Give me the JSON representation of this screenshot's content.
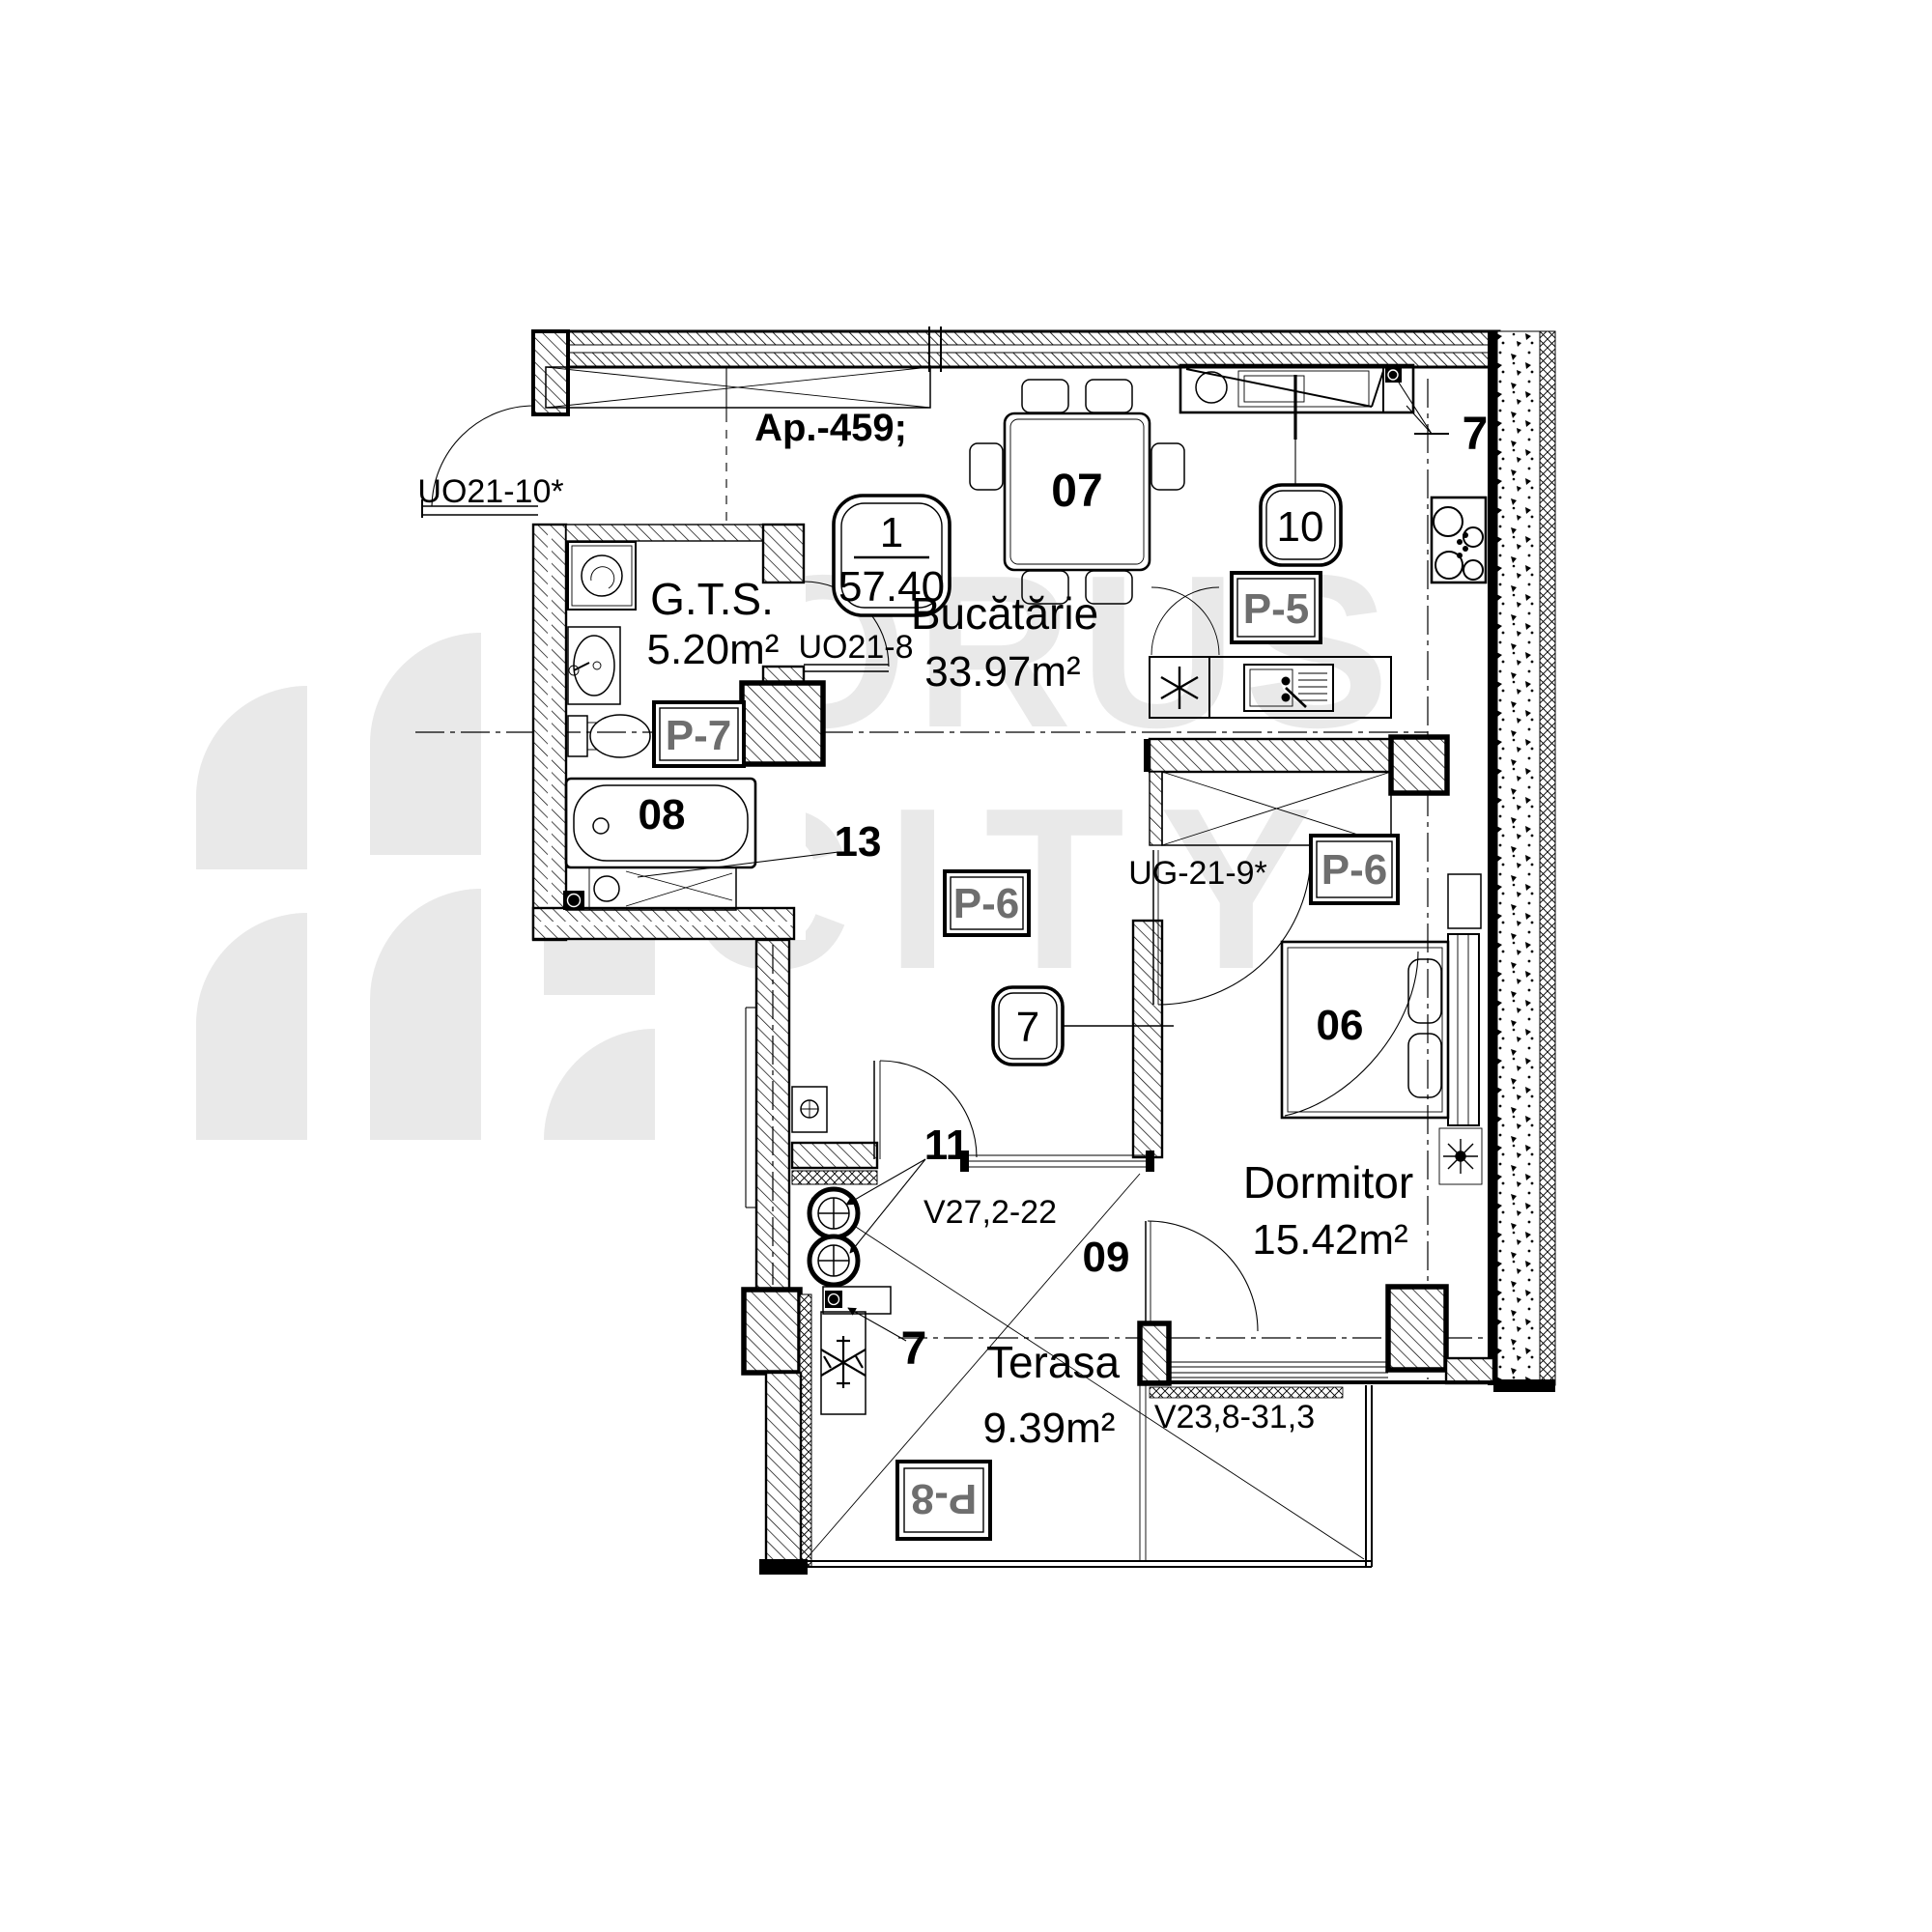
{
  "watermark": {
    "brand_line1": "HORUS",
    "brand_line2": "CITY"
  },
  "header": {
    "apartment_label": "Ap.-459;"
  },
  "unit_badge": {
    "number": "1",
    "total_area": "57.40"
  },
  "rooms": {
    "gts": {
      "name": "G.T.S.",
      "area": "5.20m²"
    },
    "kitchen": {
      "name": "Bucătărie",
      "area": "33.97m²"
    },
    "bedroom": {
      "name": "Dormitor",
      "area": "15.42m²"
    },
    "terrace": {
      "name": "Terasa",
      "area": "9.39m²"
    }
  },
  "doors": {
    "entry": "UO21-10*",
    "gts": "UO21-8",
    "bedroom": "UG-21-9*"
  },
  "windows": {
    "hall_terrace": "V27,2-22",
    "bedroom_terrace": "V23,8-31,3"
  },
  "panels": {
    "p5": "P-5",
    "p6_hall": "P-6",
    "p6_bedroom": "P-6",
    "p7": "P-7",
    "p8": "P-8"
  },
  "markers": {
    "table": "07",
    "bathtub": "08",
    "bed": "06",
    "hall": "09",
    "badge_10": "10",
    "risers": "11",
    "vanity": "13",
    "axis_badge": "7",
    "axis_top": "7",
    "axis_terrace": "7"
  }
}
